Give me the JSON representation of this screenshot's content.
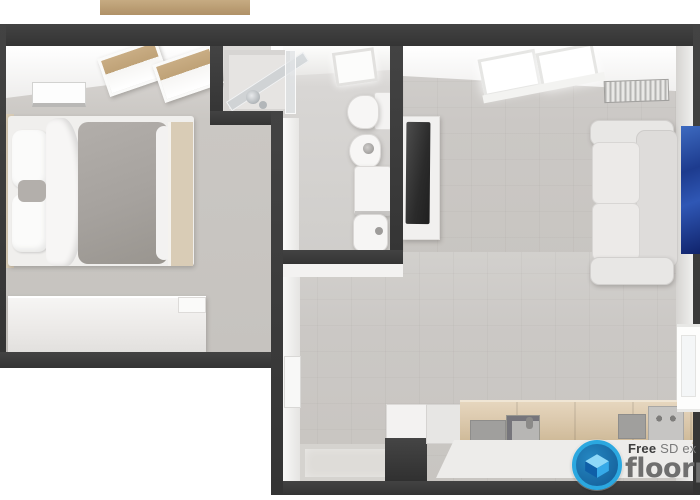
{
  "watermark": {
    "line1_bold": "Free",
    "line1_regular": " SD ex",
    "line2": "floorp",
    "ring_color": "#2BA8E0",
    "badge_inner_color": "#135A94",
    "wordmark_color": "#6F6F6F"
  },
  "palette": {
    "exterior": "#FFFFFF",
    "wall": "#3A3A3A",
    "bedroom_floor": "#C9C6C2",
    "living_floor": "#CBC8C5",
    "bathroom_floor": "#D5D3D1",
    "counter_top_wood": "#D9C6A9",
    "window_wood": "#C9AD84",
    "duvet_gray": "#A6A29E",
    "sofa_white": "#E8E7E5",
    "art_blue": "#2F57B5",
    "tv_black": "#2B2B2B"
  },
  "scene": {
    "type": "3d-top-down-floor-plan",
    "rooms": [
      {
        "id": "bedroom",
        "objects": [
          "double-bed",
          "headboard",
          "pillows",
          "accent-pillow",
          "gray-duvet",
          "footboard",
          "dresser",
          "ceiling-light",
          "wood-windows",
          "balcony-plank"
        ]
      },
      {
        "id": "bathroom",
        "objects": [
          "corner-shower",
          "toilet",
          "bidet",
          "washing-machine",
          "wash-basin",
          "ceiling-light"
        ]
      },
      {
        "id": "living-room-kitchen",
        "objects": [
          "window",
          "radiator",
          "tv-stand",
          "tv",
          "sofa",
          "blue-wall-art",
          "side-window",
          "entry-door",
          "doormat",
          "tall-dark-cabinet",
          "kitchen-counter",
          "kitchen-sink",
          "cooktop",
          "cabinet-doors"
        ]
      }
    ]
  }
}
